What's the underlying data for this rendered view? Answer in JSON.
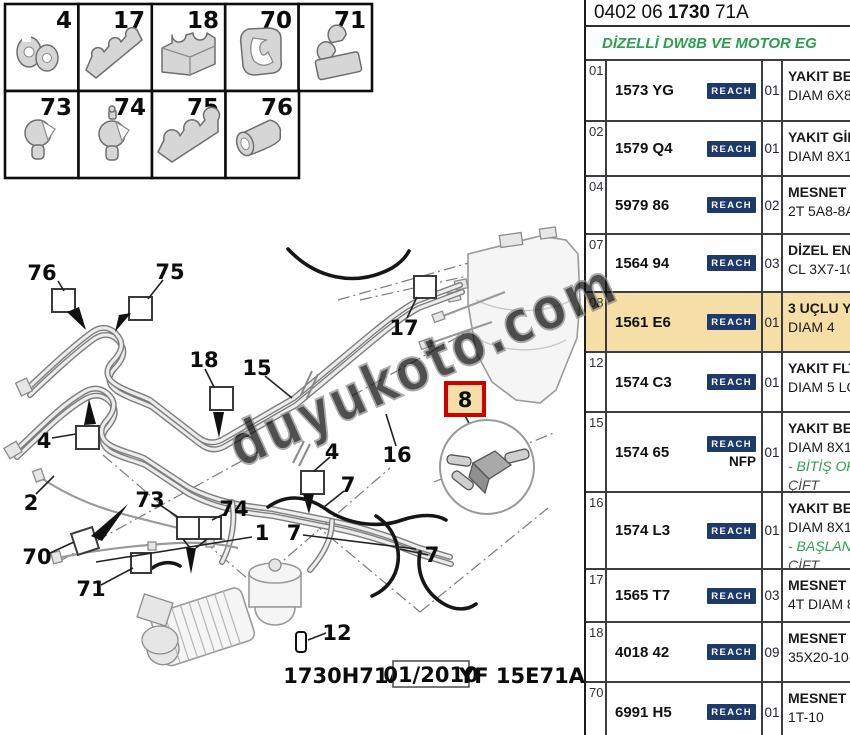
{
  "header": {
    "code_prefix": "0402 06",
    "code_bold": "1730",
    "code_suffix": "71A",
    "subtitle": "DİZELLİ DW8B VE MOTOR EG"
  },
  "table": {
    "rows": [
      {
        "ref": "01",
        "part": "1573 YG",
        "reach_label": "REACH",
        "qty": "01",
        "desc1": "YAKIT BES",
        "desc2": "DIAM 6X8"
      },
      {
        "ref": "02",
        "part": "1579 Q4",
        "reach_label": "REACH",
        "qty": "01",
        "desc1": "YAKIT GİD",
        "desc2": "DIAM 8X10"
      },
      {
        "ref": "04",
        "part": "5979 86",
        "reach_label": "REACH",
        "qty": "02",
        "desc1": "MESNET A",
        "desc2": "2T 5A8-8A"
      },
      {
        "ref": "07",
        "part": "1564 94",
        "reach_label": "REACH",
        "qty": "03",
        "desc1": "DİZEL ENJ",
        "desc2": "CL 3X7-10"
      },
      {
        "ref": "08",
        "part": "1561 E6",
        "reach_label": "REACH",
        "qty": "01",
        "desc1": "3 UÇLU YA",
        "desc2": "DIAM 4",
        "highlight": true
      },
      {
        "ref": "12",
        "part": "1574 C3",
        "reach_label": "REACH",
        "qty": "01",
        "desc1": "YAKIT FLT",
        "desc2": "DIAM 5 LG"
      },
      {
        "ref": "15",
        "part": "1574 65",
        "reach_label": "REACH",
        "nfp": "NFP",
        "qty": "01",
        "desc1": "YAKIT BES",
        "desc2": "DIAM 8X10",
        "desc3": "- BİTİŞ OP",
        "desc4": "ÇİFT"
      },
      {
        "ref": "16",
        "part": "1574 L3",
        "reach_label": "REACH",
        "qty": "01",
        "desc1": "YAKIT BES",
        "desc2": "DIAM 8X10",
        "desc3": "- BAŞLANG",
        "desc4": "ÇİFT"
      },
      {
        "ref": "17",
        "part": "1565 T7",
        "reach_label": "REACH",
        "qty": "03",
        "desc1": "MESNET A",
        "desc2": "4T DIAM 8"
      },
      {
        "ref": "18",
        "part": "4018 42",
        "reach_label": "REACH",
        "qty": "09",
        "desc1": "MESNET A",
        "desc2": "35X20-10-1"
      },
      {
        "ref": "70",
        "part": "6991 H5",
        "reach_label": "REACH",
        "qty": "01",
        "desc1": "MESNET A",
        "desc2": "1T-10"
      }
    ]
  },
  "legend": {
    "cells": [
      "4",
      "17",
      "18",
      "70",
      "71",
      "73",
      "74",
      "75",
      "76"
    ]
  },
  "diagram": {
    "callouts": [
      "76",
      "75",
      "18",
      "15",
      "17",
      "4",
      "2",
      "70",
      "73",
      "74",
      "71",
      "1",
      "7",
      "7",
      "7",
      "4",
      "16",
      "12",
      "8"
    ],
    "caption": {
      "code": "1730H71A",
      "date": "01/2010",
      "ref": "YF 15E71A"
    },
    "watermark": "duyukoto.com"
  },
  "colors": {
    "highlight": "#f6dfa6",
    "reach_bg": "#1d3a6a",
    "green_text": "#2f9e50",
    "red_box": "#cf0000"
  }
}
